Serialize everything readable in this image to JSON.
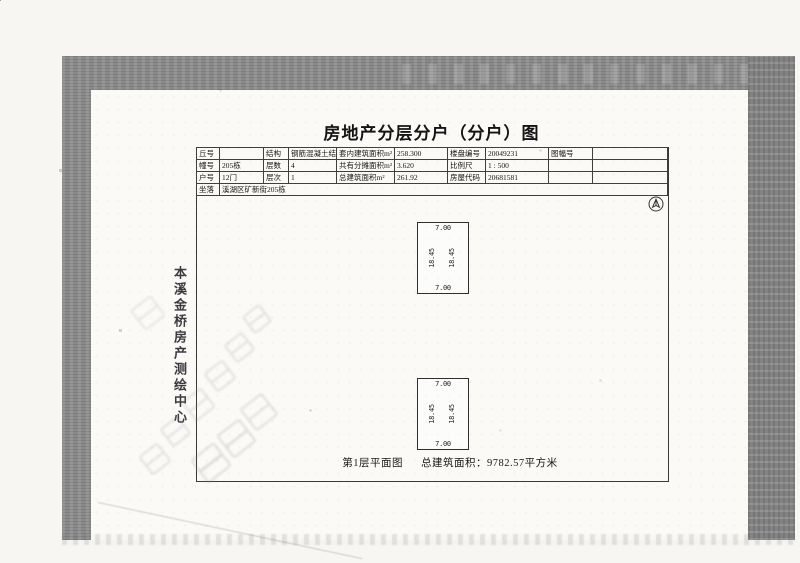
{
  "colors": {
    "scan_band": "#8a8a8a",
    "page": "#fbfaf7",
    "ink": "#1e1e1e",
    "table_line": "#3f3f3f"
  },
  "document": {
    "title": "房地产分层分户（分户）图",
    "info_table": {
      "rows": [
        {
          "cells": [
            "丘号",
            "",
            "结构",
            "钢筋混凝土结构",
            "套内建筑面积m²",
            "258.300",
            "楼盘编号",
            "20049231",
            "图幅号",
            ""
          ]
        },
        {
          "cells": [
            "幢号",
            "205栋",
            "层数",
            "4",
            "共有分摊面积m²",
            "3.620",
            "比例尺",
            "1 : 500",
            "",
            ""
          ]
        },
        {
          "cells": [
            "户号",
            "12门",
            "层次",
            "1",
            "总建筑面积m²",
            "261.92",
            "房屋代码",
            "20681581",
            "",
            ""
          ]
        }
      ],
      "location": {
        "label": "坐落",
        "value": "溪湖区矿新街205栋"
      }
    },
    "plan": {
      "north_arrow_icon": "north-arrow",
      "units": [
        {
          "top_dim": "7.00",
          "bottom_dim": "7.00",
          "left_dim": "18.45",
          "right_dim": "18.45"
        },
        {
          "top_dim": "7.00",
          "bottom_dim": "7.00",
          "left_dim": "18.45",
          "right_dim": "18.45"
        }
      ],
      "caption": {
        "floor_label": "第1层平面图",
        "area_text": "总建筑面积：9782.57平方米"
      }
    },
    "surveyor_stamp": {
      "vertical_text": "本溪金桥房产测绘中心"
    }
  }
}
